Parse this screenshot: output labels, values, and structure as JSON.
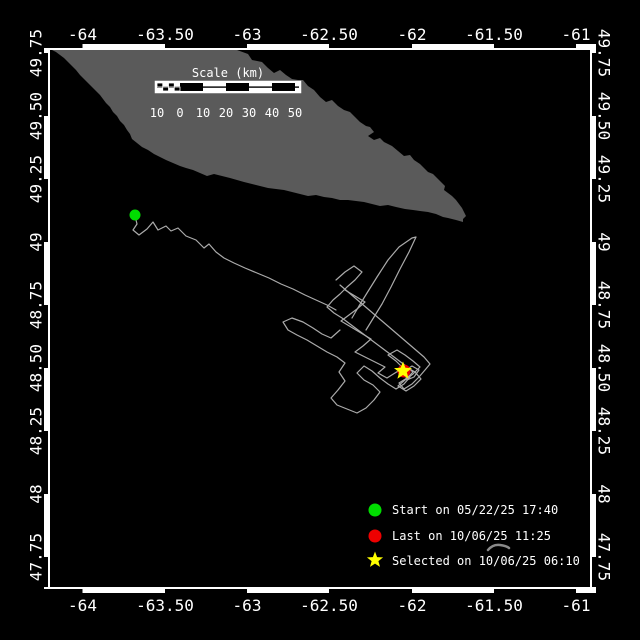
{
  "window": {
    "title": "Track map"
  },
  "colors": {
    "background": "#000000",
    "frame": "#FFFFFF",
    "island": "#5A5A5A",
    "track": "#ABABAB",
    "start_marker": "#00DD00",
    "last_marker": "#EE0000",
    "selected_marker": "#FFFF00",
    "text": "#FFFFFF",
    "cursor": "#8A8A8A"
  },
  "axes": {
    "x_labels": [
      "-64",
      "-63.50",
      "-63",
      "-62.50",
      "-62",
      "-61.50",
      "-61"
    ],
    "y_labels": [
      "49.75",
      "49.50",
      "49.25",
      "49",
      "48.75",
      "48.50",
      "48.25",
      "48",
      "47.75"
    ]
  },
  "scale_bar": {
    "title": "Scale (km)",
    "labels": [
      "10",
      "0",
      "10",
      "20",
      "30",
      "40",
      "50"
    ]
  },
  "legend": [
    {
      "marker": "circle",
      "color": "#00DD00",
      "label": "Start on 05/22/25 17:40"
    },
    {
      "marker": "circle",
      "color": "#EE0000",
      "label": "Last on 10/06/25 11:25"
    },
    {
      "marker": "star",
      "color": "#FFFF00",
      "label": "Selected on 10/06/25 06:10"
    }
  ],
  "map": {
    "island_points": "52,50 237,50 248,54 252,60 262,62 268,68 274,73 280,70 286,75 292,79 298,80 303,80 308,86 314,90 320,97 326,102 332,100 338,106 344,110 350,112 355,117 360,122 366,126 370,127 374,132 368,136 374,140 380,138 384,142 390,145 392,146 398,151 404,156 410,155 414,160 420,164 424,168 428,172 433,174 437,178 441,182 445,186 444,190 448,193 452,196 456,200 459,204 462,208 464,212 466,216 463,219 463,222 456,220 448,218 443,217 436,214 428,212 420,211 413,210 405,209 396,207 388,205 380,206 372,204 364,202 356,201 348,200 340,200 332,198 324,197 316,195 308,196 300,194 292,192 284,190 276,189 268,188 260,186 252,184 244,182 237,180 230,178 222,176 214,174 207,176 200,173 193,170 186,168 180,166 173,163 166,160 160,157 154,154 148,150 142,147 137,143 132,139 130,134 127,130 124,125 120,121 117,116 113,112 110,107 106,103 103,99 100,95 96,91 92,87 88,83 84,79 80,75 76,70 72,66 68,62 64,58 60,55 56,52"
  },
  "track": {
    "start": {
      "x": 135,
      "y": 215,
      "date": "05/22/25 17:40"
    },
    "last": {
      "x": 404,
      "y": 371,
      "date": "10/06/25 11:25"
    },
    "selected": {
      "x": 403,
      "y": 371,
      "date": "10/06/25 06:10"
    },
    "lines": [
      "135,216 137,224 133,230 139,235 147,229 153,222 158,230 166,226 171,231 178,228 186,236 196,240 204,248 209,244 216,252 224,258 234,263 245,268 257,273 269,278 281,284 293,289 305,295 316,300 327,305 336,310",
      "352,318 359,306 367,293 377,277 388,260 399,247 412,238 416,237 409,252 400,269 391,287 382,304 374,317 366,330",
      "336,280 345,272 354,266 362,272 355,280 347,287 340,294 333,300 327,307 334,313 342,318 350,324 358,330 366,336 374,342 382,348 390,354 398,360 406,366 413,372 407,378 399,383 404,389 412,384 419,377 425,370 430,364 424,357 417,351 410,345 403,339 396,333 389,327 382,321 375,315 368,309 361,303 354,297 347,291 340,285",
      "340,330 331,338 322,334 313,328 303,322 292,318 283,322 288,330 297,335 307,340 317,346 327,352 337,357 345,363 339,372 345,381 338,390 331,398 337,405 347,409 357,413 366,408 374,400 380,392 373,385 364,380 357,373 364,366 372,371 380,378 388,384 396,389 404,384 410,377",
      "345,290 355,296 365,302 357,309 349,315 341,321 351,327 361,333 371,339 363,346 355,352 365,357 375,362 385,367 378,373 387,378 395,373 403,368 396,361 388,355 397,350 405,355 413,361 420,367 413,374 405,380 398,386 406,391 414,386 421,379 415,372 408,368",
      "404,371 412,366 419,370 414,377 407,380 404,371"
    ]
  }
}
